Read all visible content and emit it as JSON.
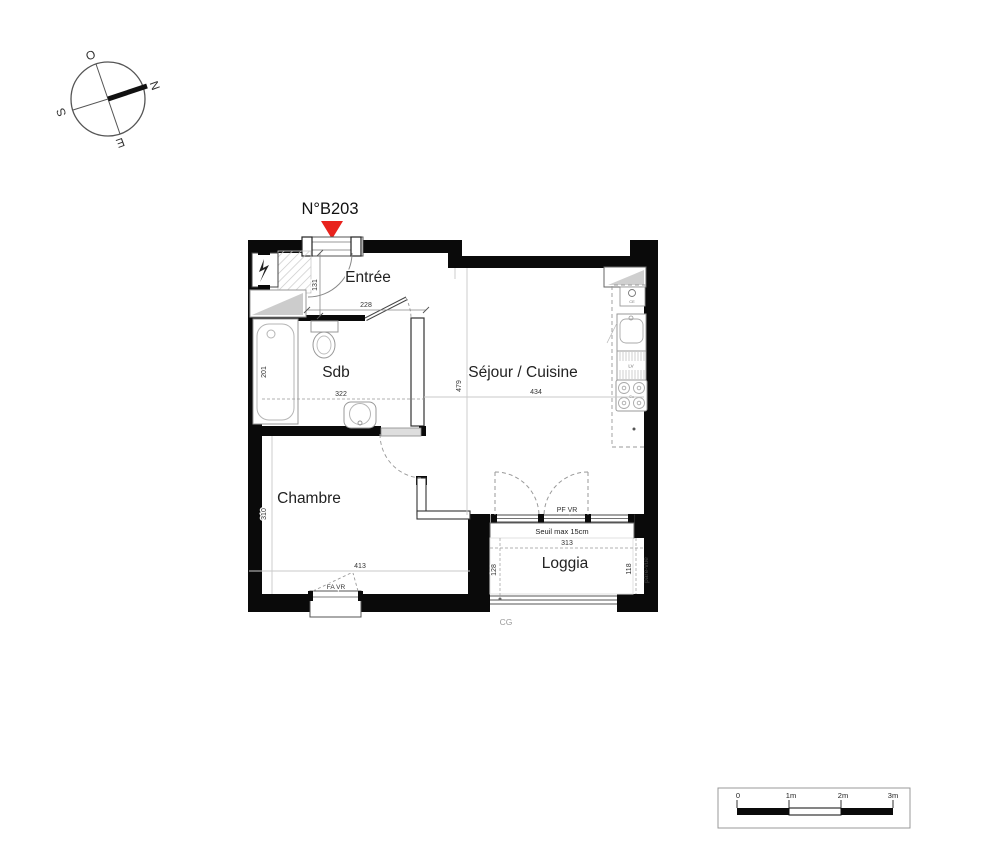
{
  "unit": {
    "number": "N°B203"
  },
  "compass": {
    "west": "O",
    "north": "N",
    "south": "S",
    "east": "E"
  },
  "rooms": {
    "entree": "Entrée",
    "sdb": "Sdb",
    "sejour_cuisine": "Séjour / Cuisine",
    "chambre": "Chambre",
    "loggia": "Loggia"
  },
  "dimensions": {
    "entree_depth": "131",
    "entree_width": "228",
    "bathtub_length": "201",
    "sdb_width": "322",
    "sejour_depth": "479",
    "sejour_width": "434",
    "chambre_depth": "310",
    "chambre_width": "413",
    "loggia_width": "313",
    "loggia_depth": "128",
    "loggia_right_depth": "118"
  },
  "annotations": {
    "loggia_door": "PF VR",
    "threshold": "Seuil max 15cm",
    "chambre_window": "FA VR",
    "privacy_screen": "pare-vue",
    "corner_mark": "CG"
  },
  "kitchen": {
    "dishwasher": "LV",
    "cooktop": "Cu",
    "water_heater": "CE"
  },
  "scale_bar": {
    "ticks": [
      "0",
      "1m",
      "2m",
      "3m"
    ]
  },
  "colors": {
    "entrance_marker": "#e8231d"
  }
}
